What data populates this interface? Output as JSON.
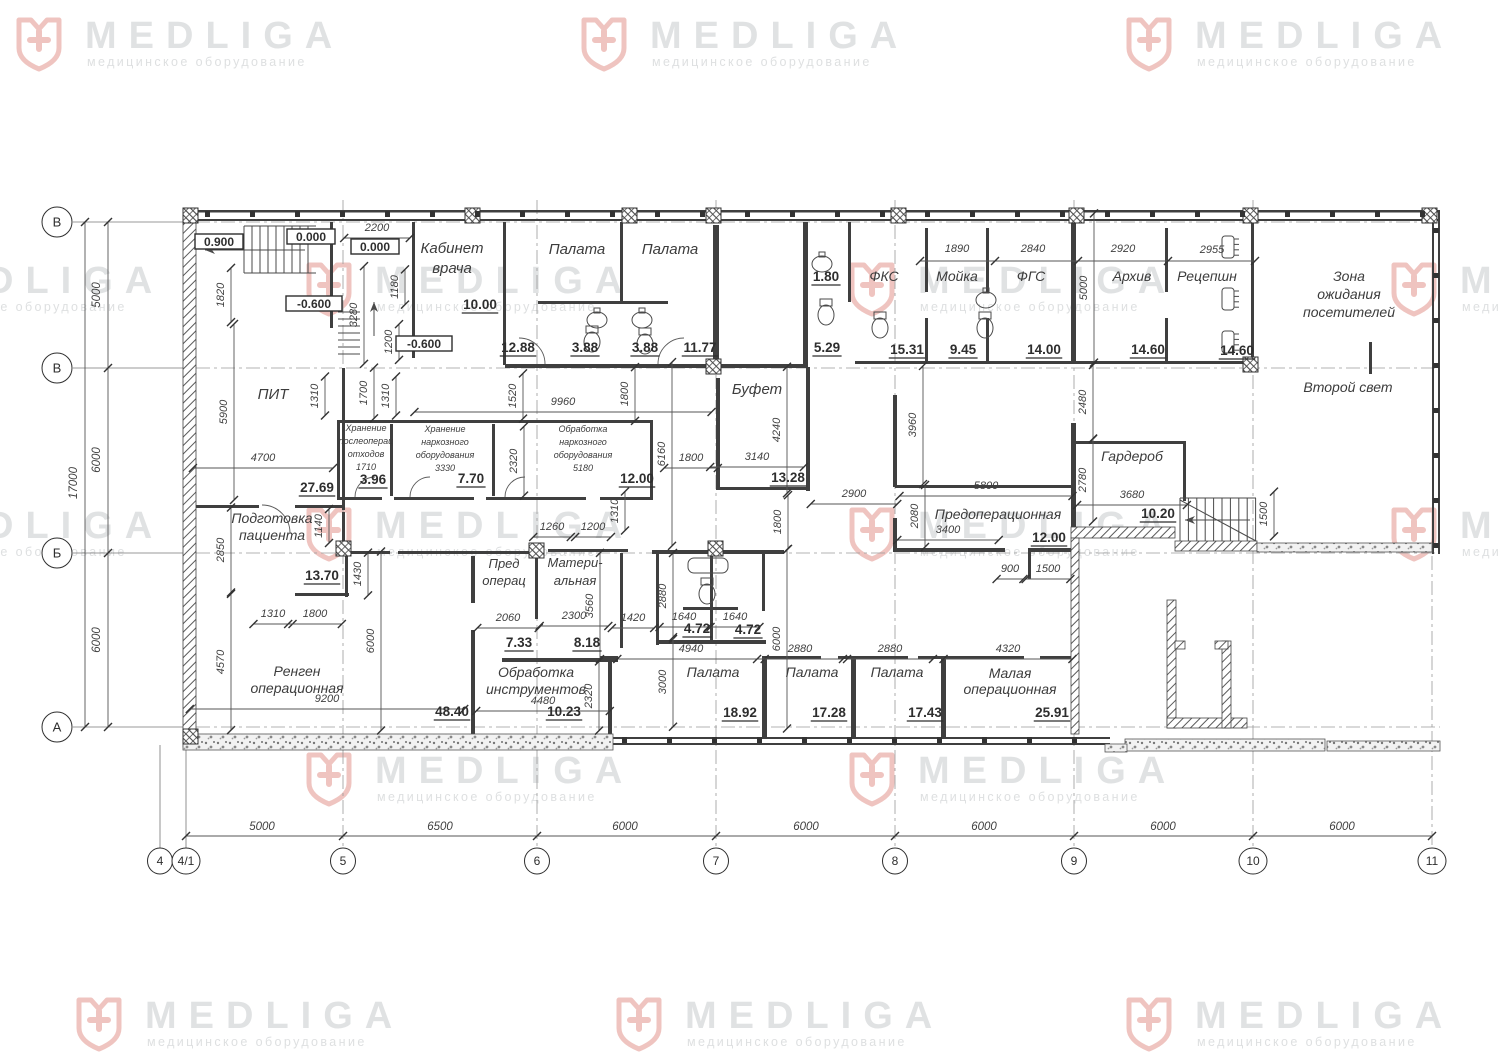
{
  "watermark": {
    "brand": "MEDLIGA",
    "tagline": "медицинское оборудование",
    "brand_color": "#c7cacc",
    "tagline_color": "#c3c6c8",
    "icon_color": "#e2948c",
    "positions": [
      [
        15,
        8
      ],
      [
        580,
        8
      ],
      [
        1125,
        8
      ],
      [
        -165,
        253
      ],
      [
        305,
        253
      ],
      [
        848,
        253
      ],
      [
        1390,
        253
      ],
      [
        -165,
        498
      ],
      [
        305,
        498
      ],
      [
        848,
        498
      ],
      [
        1390,
        498
      ],
      [
        305,
        743
      ],
      [
        848,
        743
      ],
      [
        75,
        988
      ],
      [
        615,
        988
      ],
      [
        1125,
        988
      ]
    ]
  },
  "axes": {
    "bottom": {
      "bubbles": [
        {
          "label": "4",
          "x": 160
        },
        {
          "label": "4/1",
          "x": 186
        },
        {
          "label": "5",
          "x": 343
        },
        {
          "label": "6",
          "x": 537
        },
        {
          "label": "7",
          "x": 716
        },
        {
          "label": "8",
          "x": 895
        },
        {
          "label": "9",
          "x": 1074
        },
        {
          "label": "10",
          "x": 1253
        },
        {
          "label": "11",
          "x": 1432
        }
      ],
      "bubble_y": 861,
      "dims": [
        {
          "t": "5000",
          "x": 262
        },
        {
          "t": "6500",
          "x": 440
        },
        {
          "t": "6000",
          "x": 625
        },
        {
          "t": "6000",
          "x": 806
        },
        {
          "t": "6000",
          "x": 984
        },
        {
          "t": "6000",
          "x": 1163
        },
        {
          "t": "6000",
          "x": 1342
        }
      ]
    },
    "left": {
      "bubbles": [
        {
          "label": "В",
          "y": 222
        },
        {
          "label": "В",
          "y": 368
        },
        {
          "label": "Б",
          "y": 553
        },
        {
          "label": "А",
          "y": 727
        }
      ],
      "bubble_x": 57,
      "dims": [
        {
          "t": "5000",
          "y": 295
        },
        {
          "t": "6000",
          "y": 460
        },
        {
          "t": "6000",
          "y": 640
        }
      ],
      "total": {
        "t": "17000",
        "y": 483
      }
    }
  },
  "levels": [
    {
      "t": "0.900",
      "x": 219,
      "y": 245
    },
    {
      "t": "0.000",
      "x": 311,
      "y": 240
    },
    {
      "t": "0.000",
      "x": 375,
      "y": 250
    },
    {
      "t": "-0.600",
      "x": 314,
      "y": 307
    },
    {
      "t": "-0.600",
      "x": 424,
      "y": 347
    }
  ],
  "rooms": [
    {
      "lines": [
        "Кабинет",
        "врача"
      ],
      "x": 452,
      "y": 253,
      "fs": 15,
      "lh": 20
    },
    {
      "lines": [
        "Палата"
      ],
      "x": 577,
      "y": 254,
      "fs": 15,
      "lh": 17
    },
    {
      "lines": [
        "Палата"
      ],
      "x": 670,
      "y": 254,
      "fs": 15,
      "lh": 17
    },
    {
      "lines": [
        "ФКС"
      ],
      "x": 884,
      "y": 281,
      "fs": 14,
      "lh": 17
    },
    {
      "lines": [
        "Мойка"
      ],
      "x": 957,
      "y": 281,
      "fs": 14,
      "lh": 17
    },
    {
      "lines": [
        "ФГС"
      ],
      "x": 1031,
      "y": 281,
      "fs": 14,
      "lh": 17
    },
    {
      "lines": [
        "Архив"
      ],
      "x": 1132,
      "y": 281,
      "fs": 14,
      "lh": 17
    },
    {
      "lines": [
        "Рецепшн"
      ],
      "x": 1207,
      "y": 281,
      "fs": 14,
      "lh": 17
    },
    {
      "lines": [
        "Зона",
        "ожидания",
        "посетителей"
      ],
      "x": 1349,
      "y": 281,
      "fs": 14,
      "lh": 18
    },
    {
      "lines": [
        "ПИТ"
      ],
      "x": 273,
      "y": 399,
      "fs": 15,
      "lh": 17
    },
    {
      "lines": [
        "Буфет"
      ],
      "x": 757,
      "y": 394,
      "fs": 15,
      "lh": 17
    },
    {
      "lines": [
        "Второй свет"
      ],
      "x": 1348,
      "y": 392,
      "fs": 14,
      "lh": 17
    },
    {
      "lines": [
        "Хранение",
        "послеоперац",
        "отходов",
        "1710"
      ],
      "x": 366,
      "y": 431,
      "fs": 9,
      "lh": 13
    },
    {
      "lines": [
        "Хранение",
        "наркозного",
        "оборудования",
        "3330"
      ],
      "x": 445,
      "y": 432,
      "fs": 9,
      "lh": 13
    },
    {
      "lines": [
        "Обработка",
        "наркозного",
        "оборудования",
        "5180"
      ],
      "x": 583,
      "y": 432,
      "fs": 9,
      "lh": 13
    },
    {
      "lines": [
        "Подготовка",
        "пациента"
      ],
      "x": 272,
      "y": 523,
      "fs": 14,
      "lh": 17
    },
    {
      "lines": [
        "Предоперационная"
      ],
      "x": 998,
      "y": 519,
      "fs": 14,
      "lh": 17
    },
    {
      "lines": [
        "Гардероб"
      ],
      "x": 1132,
      "y": 461,
      "fs": 14,
      "lh": 17
    },
    {
      "lines": [
        "Пред",
        "операц"
      ],
      "x": 504,
      "y": 568,
      "fs": 13,
      "lh": 17
    },
    {
      "lines": [
        "Матери-",
        "альная"
      ],
      "x": 575,
      "y": 567,
      "fs": 13,
      "lh": 18
    },
    {
      "lines": [
        "Ренген",
        "операционная"
      ],
      "x": 297,
      "y": 676,
      "fs": 14,
      "lh": 17
    },
    {
      "lines": [
        "Обработка",
        "инструментов"
      ],
      "x": 536,
      "y": 677,
      "fs": 14,
      "lh": 17
    },
    {
      "lines": [
        "Палата"
      ],
      "x": 713,
      "y": 677,
      "fs": 14,
      "lh": 17
    },
    {
      "lines": [
        "Палата"
      ],
      "x": 812,
      "y": 677,
      "fs": 14,
      "lh": 17
    },
    {
      "lines": [
        "Палата"
      ],
      "x": 897,
      "y": 677,
      "fs": 14,
      "lh": 17
    },
    {
      "lines": [
        "Малая",
        "операционная"
      ],
      "x": 1010,
      "y": 678,
      "fs": 14,
      "lh": 16
    }
  ],
  "areas": [
    {
      "t": "10.00",
      "x": 480,
      "y": 309
    },
    {
      "t": "12.88",
      "x": 518,
      "y": 352
    },
    {
      "t": "3.88",
      "x": 585,
      "y": 352
    },
    {
      "t": "3.88",
      "x": 645,
      "y": 352
    },
    {
      "t": "11.77",
      "x": 700,
      "y": 352
    },
    {
      "t": "1.80",
      "x": 826,
      "y": 281
    },
    {
      "t": "5.29",
      "x": 827,
      "y": 352
    },
    {
      "t": "15.31",
      "x": 907,
      "y": 354
    },
    {
      "t": "9.45",
      "x": 963,
      "y": 354
    },
    {
      "t": "14.00",
      "x": 1044,
      "y": 354
    },
    {
      "t": "14.60",
      "x": 1148,
      "y": 354
    },
    {
      "t": "14.60",
      "x": 1237,
      "y": 355
    },
    {
      "t": "27.69",
      "x": 317,
      "y": 492
    },
    {
      "t": "3.96",
      "x": 373,
      "y": 484
    },
    {
      "t": "7.70",
      "x": 471,
      "y": 483
    },
    {
      "t": "12.00",
      "x": 637,
      "y": 483
    },
    {
      "t": "13.28",
      "x": 788,
      "y": 482
    },
    {
      "t": "10.20",
      "x": 1158,
      "y": 518
    },
    {
      "t": "12.00",
      "x": 1049,
      "y": 542
    },
    {
      "t": "13.70",
      "x": 322,
      "y": 580
    },
    {
      "t": "7.33",
      "x": 519,
      "y": 647
    },
    {
      "t": "8.18",
      "x": 587,
      "y": 647
    },
    {
      "t": "4.72",
      "x": 697,
      "y": 633
    },
    {
      "t": "4.72",
      "x": 748,
      "y": 634
    },
    {
      "t": "48.40",
      "x": 452,
      "y": 716
    },
    {
      "t": "10.23",
      "x": 564,
      "y": 716
    },
    {
      "t": "18.92",
      "x": 740,
      "y": 717
    },
    {
      "t": "17.28",
      "x": 829,
      "y": 717
    },
    {
      "t": "17.43",
      "x": 925,
      "y": 717
    },
    {
      "t": "25.91",
      "x": 1052,
      "y": 717
    }
  ],
  "dims_h": [
    {
      "t": "2200",
      "x": 377,
      "y": 231
    },
    {
      "t": "1890",
      "x": 957,
      "y": 252,
      "noline": true
    },
    {
      "t": "2840",
      "x": 1033,
      "y": 252,
      "noline": true
    },
    {
      "t": "2920",
      "x": 1123,
      "y": 252,
      "noline": true
    },
    {
      "t": "2955",
      "x": 1212,
      "y": 253,
      "noline": true
    },
    {
      "t": "9960",
      "x": 563,
      "y": 405
    },
    {
      "t": "4700",
      "x": 263,
      "y": 461
    },
    {
      "t": "1800",
      "x": 691,
      "y": 461
    },
    {
      "t": "3140",
      "x": 757,
      "y": 460
    },
    {
      "t": "2900",
      "x": 854,
      "y": 497
    },
    {
      "t": "5800",
      "x": 986,
      "y": 489
    },
    {
      "t": "3400",
      "x": 948,
      "y": 533
    },
    {
      "t": "3680",
      "x": 1132,
      "y": 498
    },
    {
      "t": "1260",
      "x": 552,
      "y": 530
    },
    {
      "t": "1200",
      "x": 593,
      "y": 530
    },
    {
      "t": "1310",
      "x": 273,
      "y": 617
    },
    {
      "t": "1800",
      "x": 315,
      "y": 617
    },
    {
      "t": "2060",
      "x": 508,
      "y": 621
    },
    {
      "t": "2300",
      "x": 574,
      "y": 619
    },
    {
      "t": "1420",
      "x": 633,
      "y": 621
    },
    {
      "t": "1640",
      "x": 684,
      "y": 620
    },
    {
      "t": "1640",
      "x": 735,
      "y": 620
    },
    {
      "t": "4940",
      "x": 691,
      "y": 652
    },
    {
      "t": "2880",
      "x": 800,
      "y": 652
    },
    {
      "t": "2880",
      "x": 890,
      "y": 652
    },
    {
      "t": "4320",
      "x": 1008,
      "y": 652
    },
    {
      "t": "4480",
      "x": 543,
      "y": 704
    },
    {
      "t": "9200",
      "x": 327,
      "y": 702
    },
    {
      "t": "900",
      "x": 1010,
      "y": 572
    },
    {
      "t": "1500",
      "x": 1048,
      "y": 572
    }
  ],
  "dims_v": [
    {
      "t": "1820",
      "x": 224,
      "y": 295
    },
    {
      "t": "1180",
      "x": 398,
      "y": 287
    },
    {
      "t": "3280",
      "x": 357,
      "y": 315
    },
    {
      "t": "1200",
      "x": 392,
      "y": 342
    },
    {
      "t": "5900",
      "x": 227,
      "y": 412
    },
    {
      "t": "1310",
      "x": 318,
      "y": 396
    },
    {
      "t": "1700",
      "x": 367,
      "y": 393
    },
    {
      "t": "1310",
      "x": 389,
      "y": 396
    },
    {
      "t": "1520",
      "x": 516,
      "y": 396
    },
    {
      "t": "1800",
      "x": 628,
      "y": 394
    },
    {
      "t": "2320",
      "x": 517,
      "y": 461
    },
    {
      "t": "6160",
      "x": 665,
      "y": 454
    },
    {
      "t": "4240",
      "x": 780,
      "y": 430
    },
    {
      "t": "3960",
      "x": 916,
      "y": 425
    },
    {
      "t": "2480",
      "x": 1086,
      "y": 402
    },
    {
      "t": "5000",
      "x": 1087,
      "y": 288
    },
    {
      "t": "2780",
      "x": 1086,
      "y": 480
    },
    {
      "t": "2080",
      "x": 918,
      "y": 516
    },
    {
      "t": "1140",
      "x": 322,
      "y": 526
    },
    {
      "t": "2850",
      "x": 224,
      "y": 550
    },
    {
      "t": "1430",
      "x": 361,
      "y": 574
    },
    {
      "t": "6000",
      "x": 374,
      "y": 641
    },
    {
      "t": "4570",
      "x": 224,
      "y": 662
    },
    {
      "t": "1310",
      "x": 618,
      "y": 511
    },
    {
      "t": "3560",
      "x": 593,
      "y": 606
    },
    {
      "t": "2880",
      "x": 666,
      "y": 596
    },
    {
      "t": "3000",
      "x": 666,
      "y": 682
    },
    {
      "t": "6000",
      "x": 780,
      "y": 639
    },
    {
      "t": "1800",
      "x": 781,
      "y": 522
    },
    {
      "t": "2320",
      "x": 592,
      "y": 696
    },
    {
      "t": "1500",
      "x": 1267,
      "y": 514
    }
  ]
}
